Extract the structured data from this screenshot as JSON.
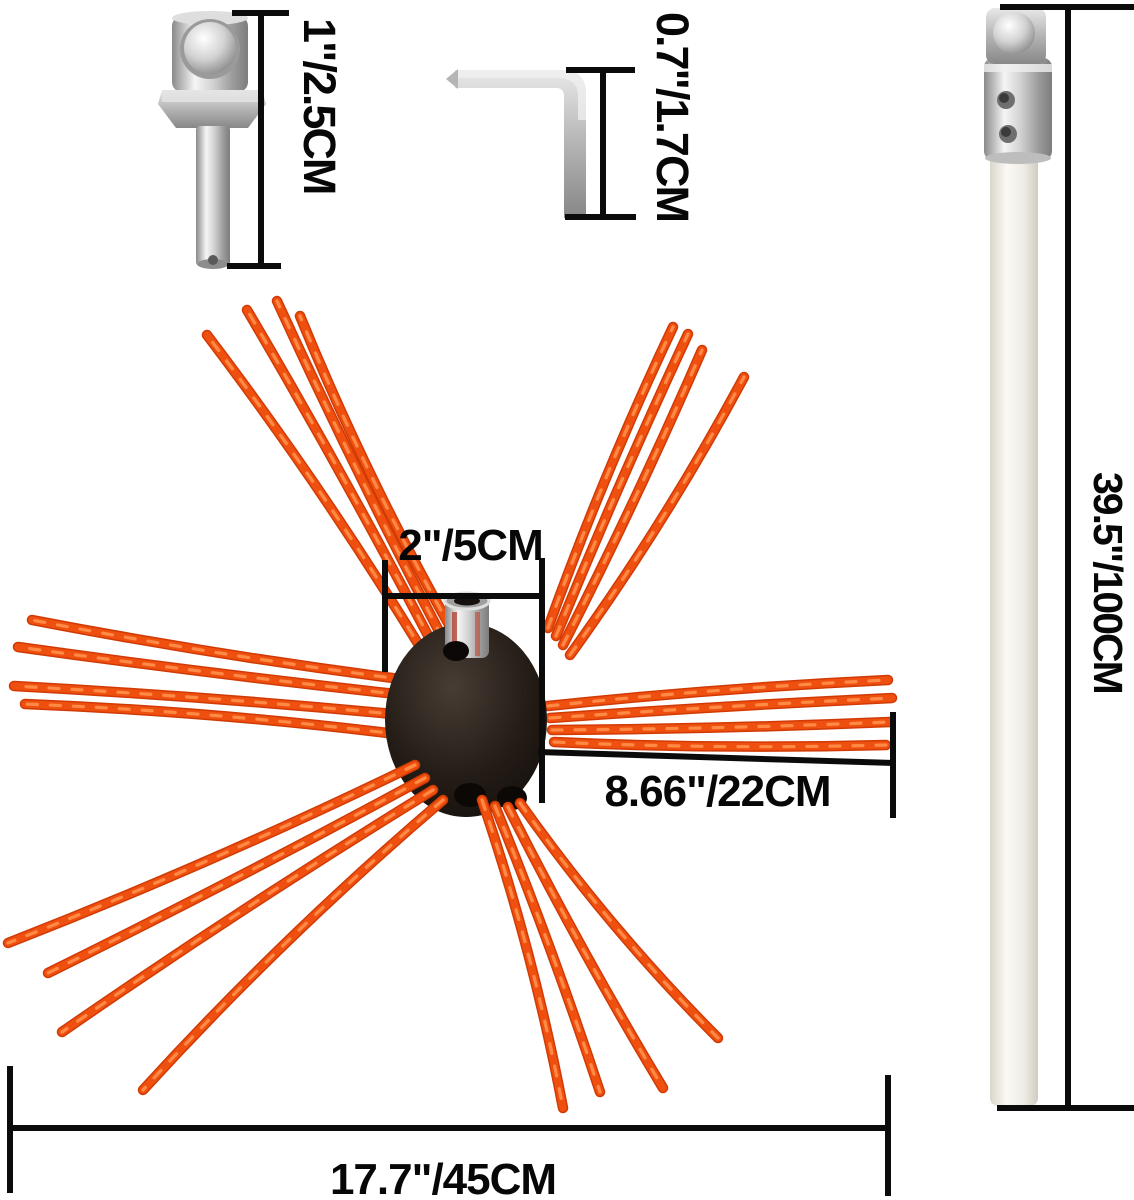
{
  "figure": {
    "background_color": "#ffffff",
    "dimension_line_color": "#0b0b0b",
    "label_text_color": "#070707",
    "bristle_color": "#e8470e",
    "bristle_highlight_color": "#ff8a45",
    "hub_color": "#1c1511",
    "rod_color": "#f4f2ea",
    "metal_color": "#c9c9c9"
  },
  "labels": {
    "adapter_length": "1\"/2.5CM",
    "wrench_length": "0.7\"/1.7CM",
    "rod_length": "39.5\"/100CM",
    "hub_width": "2\"/5CM",
    "bristle_length": "8.66\"/22CM",
    "brush_diameter": "17.7\"/45CM"
  }
}
